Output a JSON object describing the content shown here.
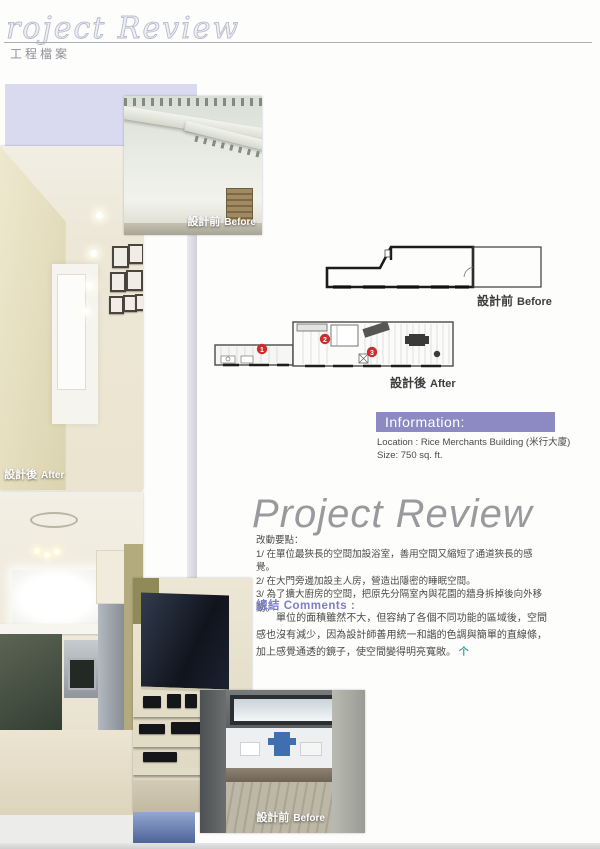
{
  "header": {
    "script_title": "roject Review",
    "subtitle": "工程檔案"
  },
  "labels": {
    "before_cjk": "設計前",
    "before_en": "Before",
    "after_cjk": "設計後",
    "after_en": "After"
  },
  "plans": {
    "markers": [
      "1",
      "2",
      "3"
    ]
  },
  "information": {
    "heading": "Information:",
    "location": "Location : Rice Merchants Building (米行大廈)",
    "size": "Size: 750 sq. ft."
  },
  "article": {
    "title": "Project Review",
    "points_heading": "改動要點：",
    "points": [
      "1/ 在單位最狹長的空間加設浴室，善用空間又縮短了通道狹長的感覺。",
      "2/ 在大門旁邊加設主人房，營造出隱密的睡眠空間。",
      "3/ 為了擴大廚房的空間，把原先分隔室內與花園的牆身拆掉後向外移動。"
    ],
    "comments_heading": "總結 Comments :",
    "comments_body": "單位的面積雖然不大，但容納了各個不同功能的區域後，空間感也沒有減少，因為設計師善用統一和諧的色調與簡單的直線條，加上感覺通透的鏡子，使空間變得明亮寬敞。",
    "end_mark": "个"
  },
  "colors": {
    "accent_purple": "#8d89c2",
    "comments_purple": "#7d7ec5",
    "lavender_block": "#d9d9ef",
    "end_mark_teal": "#35a39c",
    "marker_red": "#c92f2f"
  }
}
